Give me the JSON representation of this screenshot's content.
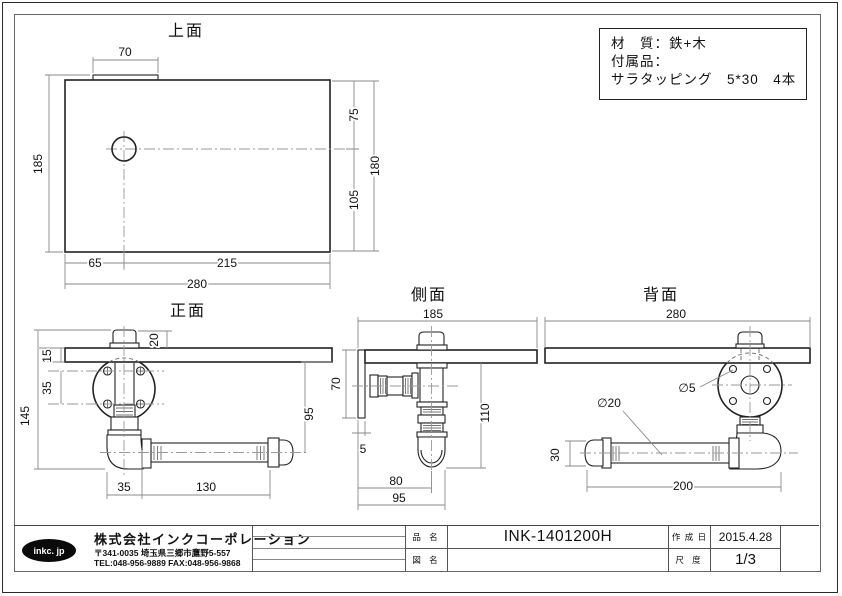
{
  "material_box": {
    "line1": "材　質：鉄+木",
    "line2": "付属品：",
    "line3": "サラタッピング　5*30　4本"
  },
  "views": {
    "top": {
      "title": "上面",
      "dim_tab": "70",
      "dim_depth_total": "185",
      "dim_right_top": "75",
      "dim_right_bottom": "105",
      "dim_right_total": "180",
      "dim_bottom_left": "65",
      "dim_bottom_right": "215",
      "dim_width_total": "280"
    },
    "front": {
      "title": "正面",
      "dim_cap": "20",
      "dim_board_thk": "15",
      "dim_screw_pitch": "35",
      "dim_height_total": "145",
      "dim_drop": "95",
      "dim_elbow": "35",
      "dim_bar": "130"
    },
    "side": {
      "title": "側面",
      "dim_depth": "185",
      "dim_plate": "70",
      "dim_plate_thk": "5",
      "dim_drop": "110",
      "dim_offset": "80",
      "dim_offset_total": "95"
    },
    "back": {
      "title": "背面",
      "dim_width": "280",
      "dia_hole": "∅5",
      "dia_pipe": "∅20",
      "dim_bar_h": "30",
      "dim_bar_len": "200"
    }
  },
  "title_block": {
    "logo": "inkc. jp",
    "company": "株式会社インクコーポレーション",
    "address": "〒341-0035 埼玉県三郷市鷹野5-557",
    "tel": "TEL:048-956-9889  FAX:048-956-9868",
    "part_label": "品 名",
    "part_no": "INK-1401200H",
    "drawing_label": "図 名",
    "drawing_name": "",
    "date_label": "作 成 日",
    "date": "2015.4.28",
    "scale_label": "尺 度",
    "scale": "1/3"
  }
}
